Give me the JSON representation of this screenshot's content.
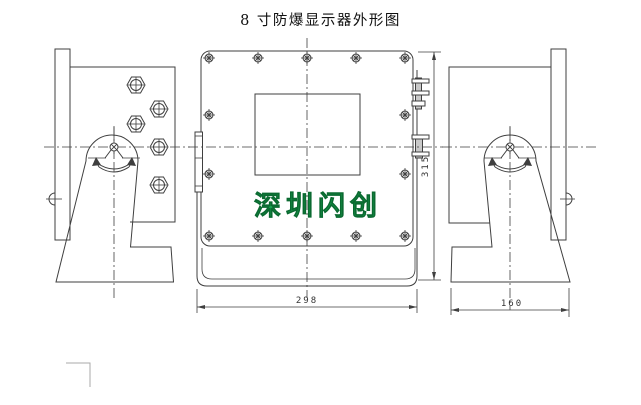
{
  "title": "8 寸防爆显示器外形图",
  "watermark_text": "深圳闪创",
  "dimensions": {
    "front_width": "298",
    "front_height": "315",
    "side_depth": "160"
  },
  "icons": {
    "hex_bolt": "hexagon-with-cross-bolt-head",
    "cover_screw": "circle-with-x-screw-head",
    "pivot_joint": "circle-on-triangle-pivot",
    "rotation_arrow": "curved-double-arrow"
  },
  "colors": {
    "background": "#ffffff",
    "line": "#3f3f3f",
    "watermark": "#17a04e",
    "dimension_text": "#333333"
  }
}
